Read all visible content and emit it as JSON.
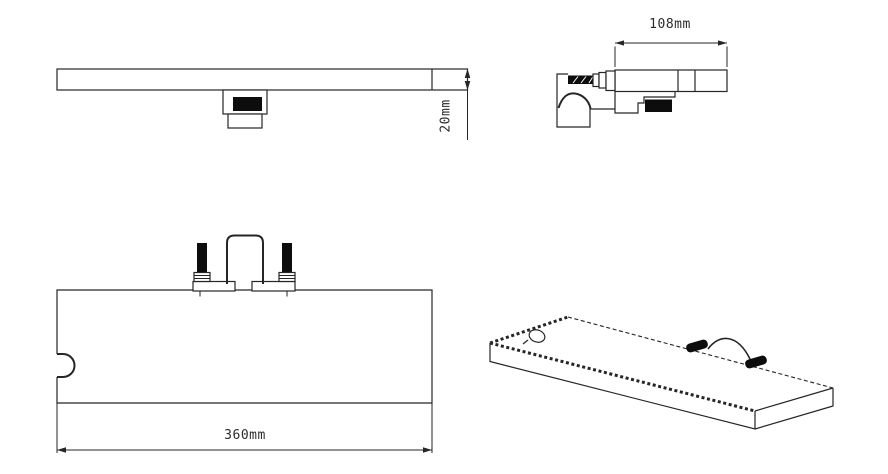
{
  "drawing": {
    "background": "#ffffff",
    "line_color": "#262626",
    "fill_color": "#0d0d0d",
    "dimensions": {
      "side_depth": "108mm",
      "thickness": "20mm",
      "length": "360mm"
    }
  }
}
